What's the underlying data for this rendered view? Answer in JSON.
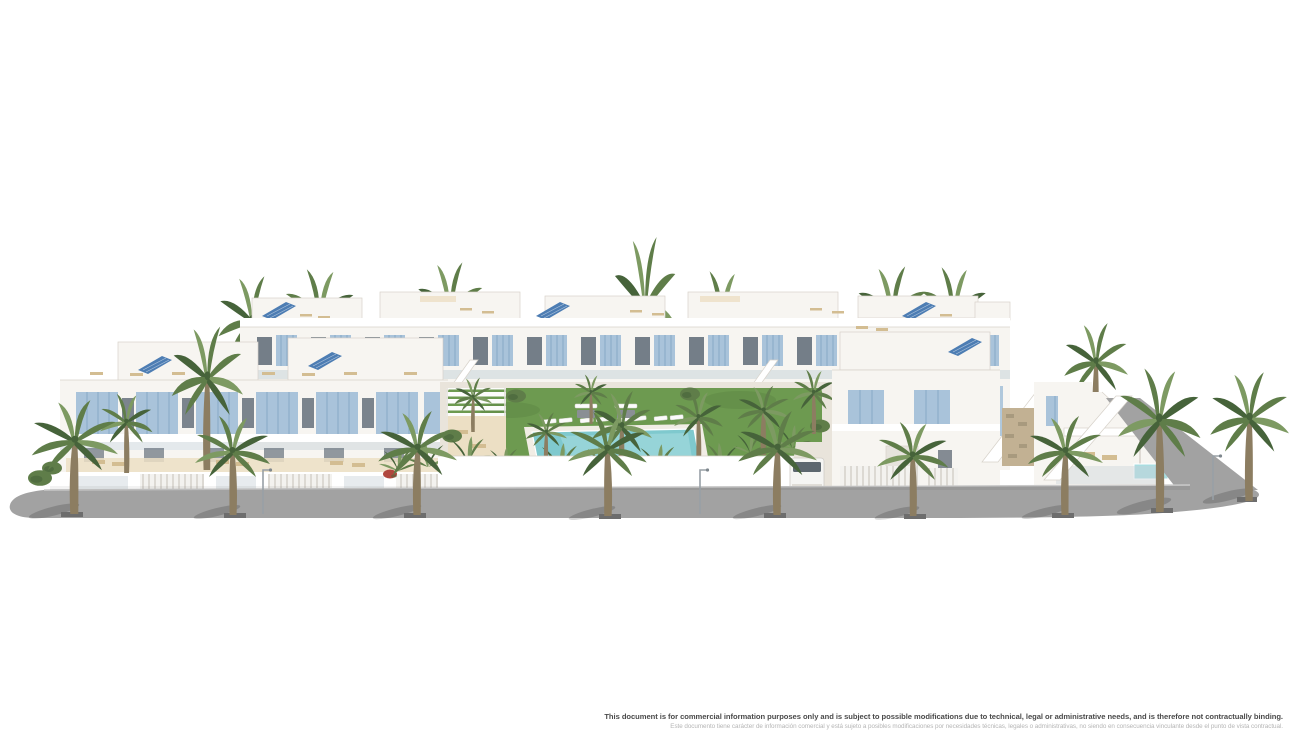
{
  "scene": {
    "alt": "Aerial 3D architectural rendering of a white Mediterranean residential complex with light-blue shutters, rooftop terraces with sun loungers, blue solar panels, a central landscaped courtyard with turquoise swimming pool and white loungers, tropical plants, and palm trees lining a grey street in the foreground",
    "colors": {
      "white": "#ffffff",
      "building": "#f7f5f1",
      "buildingShade": "#ece8e1",
      "buildingDark": "#ddd8d0",
      "outline": "#d7d2ca",
      "shutter": "#a9c3da",
      "shutterDark": "#86a8c5",
      "glass": "#66717c",
      "glassLight": "#c9d3d9",
      "solar": "#4d7db3",
      "terrace": "#ecdfc4",
      "lounger": "#d3bd92",
      "stone": "#c2b193",
      "lawn": "#6d9a50",
      "lawnDark": "#5a8542",
      "pool": "#7fc9ce",
      "poolLight": "#aadde0",
      "palm": "#5f7d49",
      "palmLight": "#7d9a62",
      "palmDark": "#46633a",
      "trunk": "#8c7d61",
      "road": "#a2a2a2",
      "roadShade": "#8d8d8d",
      "curb": "#c9c9c9",
      "grate": "#6d6d6d",
      "paving": "#e9e4db",
      "flower": "#b0473e",
      "textPrimary": "#4a4a4a",
      "textSecondary": "#b5b5b5"
    }
  },
  "footer": {
    "line_en": "This document is for commercial information purposes only and is subject to possible modifications due to technical, legal or administrative needs, and is therefore not contractually binding.",
    "line_es": "Este documento tiene carácter de información comercial y está sujeto a posibles modificaciones por necesidades técnicas, legales o administrativas, no siendo en consecuencia vinculante desde el punto de vista contractual."
  }
}
